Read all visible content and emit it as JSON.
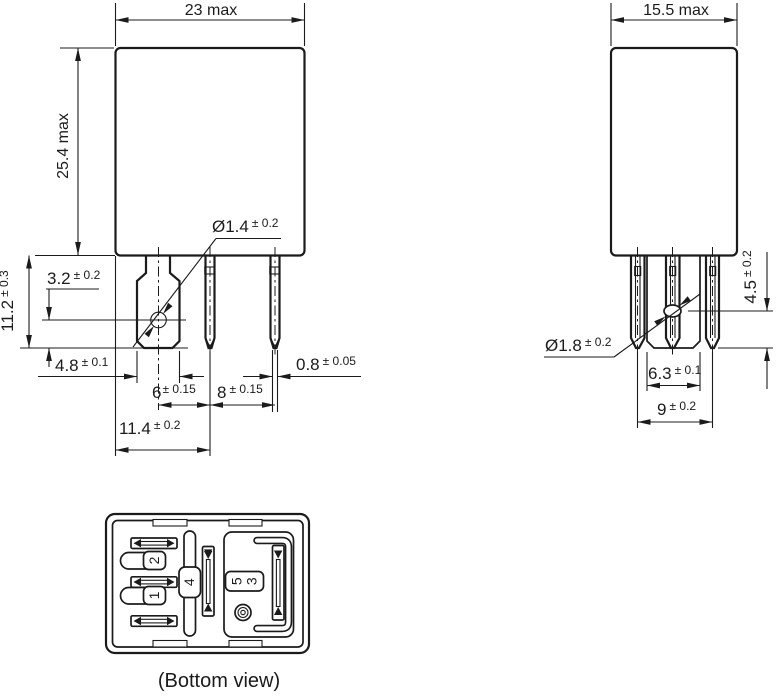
{
  "drawing": {
    "front_view": {
      "width_max": "23 max",
      "height_max": "25.4 max",
      "hole_diameter": {
        "value": "Ø1.4",
        "tolerance": "± 0.2"
      },
      "hole_offset": {
        "value": "3.2",
        "tolerance": "± 0.2"
      },
      "pin_length": {
        "value": "11.2",
        "tolerance": "± 0.3"
      },
      "blade_width": {
        "value": "4.8",
        "tolerance": "± 0.1"
      },
      "pitch_blade_to_pin": {
        "value": "6",
        "tolerance": "± 0.15"
      },
      "pitch_pin_to_pin": {
        "value": "8",
        "tolerance": "± 0.15"
      },
      "pin_thickness": {
        "value": "0.8",
        "tolerance": "± 0.05"
      },
      "edge_to_pin": {
        "value": "11.4",
        "tolerance": "± 0.2"
      }
    },
    "side_view": {
      "width_max": "15.5 max",
      "hole_offset": {
        "value": "4.5",
        "tolerance": "± 0.2"
      },
      "hole_diameter": {
        "value": "Ø1.8",
        "tolerance": "± 0.2"
      },
      "blade_width": {
        "value": "6.3",
        "tolerance": "± 0.1"
      },
      "pitch_outer": {
        "value": "9",
        "tolerance": "± 0.2"
      }
    },
    "bottom_view": {
      "caption": "(Bottom view)",
      "pin_labels": {
        "p1": "1",
        "p2": "2",
        "p3": "3",
        "p4": "4",
        "p5": "5"
      }
    }
  }
}
